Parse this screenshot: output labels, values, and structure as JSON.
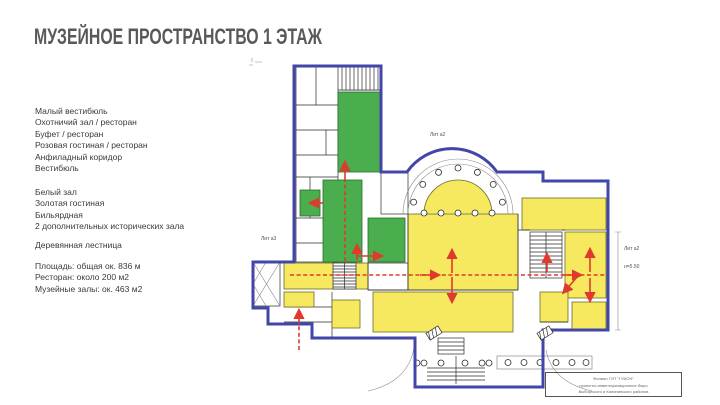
{
  "title": "МУЗЕЙНОЕ ПРОСТРАНСТВО 1 ЭТАЖ",
  "legend": {
    "block1": [
      "Малый вестибюль",
      "Охотничий зал / ресторан",
      "Буфет / ресторан",
      "Розовая гостиная / ресторан",
      "Анфиладный коридор",
      "Вестибюль"
    ],
    "block2": [
      "Белый зал",
      "Золотая гостиная",
      "Бильярдная",
      "2 дополнительных исторических зала"
    ],
    "block3": [
      "Деревянная лестница"
    ],
    "block4": [
      "Площадь: общая ок. 836 м",
      "Ресторан: около 200 м2",
      "Музейные залы: ок. 463 м2"
    ]
  },
  "plan": {
    "labels": {
      "lit_top": "Лит а2",
      "lit_left": "Лит а3",
      "lit_right": "Лит а2",
      "height_mark": "н=5.50"
    },
    "stamp": [
      "Филиал ГУП \"ГУИОН\"",
      "проектно-инвентаризационное бюро",
      "Выборгского и Калининского районов"
    ],
    "colors": {
      "boundary": "#4246a8",
      "museum_room": "#f6e960",
      "restaurant_room": "#4aae4e",
      "route": "#e0392e",
      "walls": "#2b2b2b"
    }
  }
}
